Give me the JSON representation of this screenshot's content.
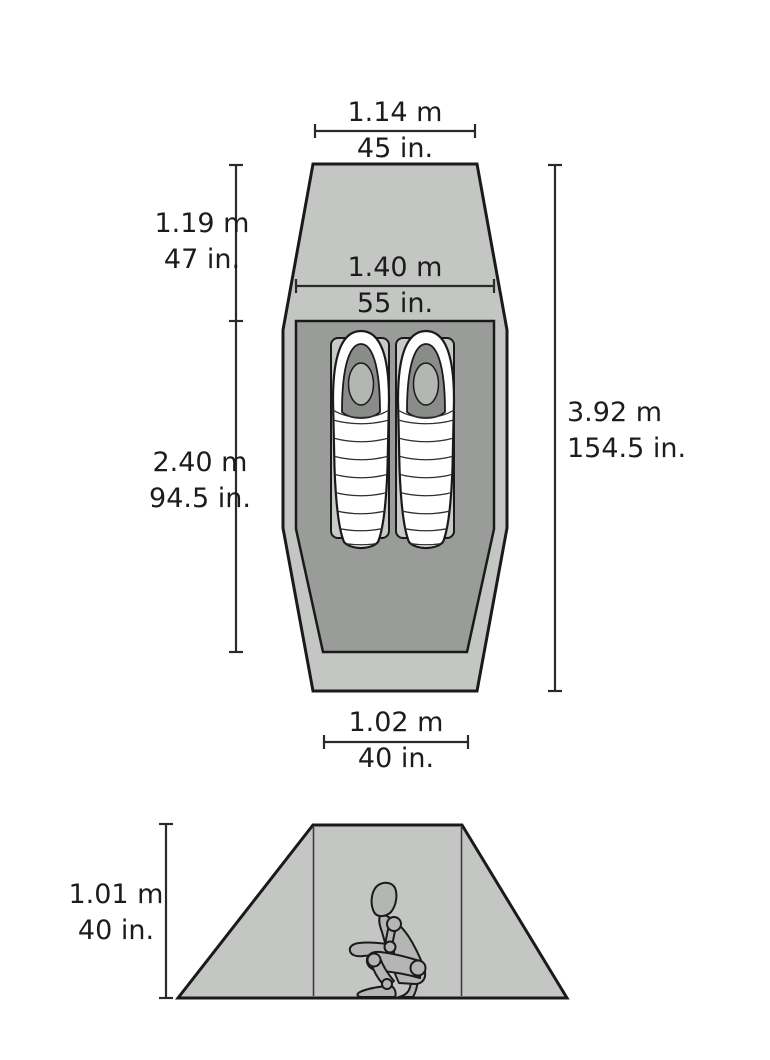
{
  "diagram": {
    "subject": "tent-dimensions-spec",
    "colors": {
      "background": "#ffffff",
      "outer_shell": "#c4c6c4",
      "inner_tent": "#9a9c9a",
      "pad": "#c9cbc9",
      "bag": "#ffffff",
      "hood_shadow": "#8a8c8a",
      "figure": "#b4b6b4",
      "outline": "#1a1a1a",
      "dimension_line": "#2a2a2a",
      "text": "#1c1c1c"
    },
    "plan_view": {
      "dimensions": {
        "top_width": {
          "metric": "1.14 m",
          "imperial": "45 in."
        },
        "vestibule_depth": {
          "metric": "1.19 m",
          "imperial": "47 in."
        },
        "inner_width": {
          "metric": "1.40 m",
          "imperial": "55 in."
        },
        "inner_length": {
          "metric": "2.40 m",
          "imperial": "94.5 in."
        },
        "total_length": {
          "metric": "3.92 m",
          "imperial": "154.5 in."
        },
        "foot_width": {
          "metric": "1.02 m",
          "imperial": "40 in."
        }
      },
      "contents": [
        "sleeping-bag-left",
        "sleeping-bag-right",
        "sleeping-pad-left",
        "sleeping-pad-right"
      ]
    },
    "elevation_view": {
      "dimensions": {
        "peak_height": {
          "metric": "1.01 m",
          "imperial": "40 in."
        }
      },
      "contents": [
        "crouching-person"
      ]
    }
  }
}
